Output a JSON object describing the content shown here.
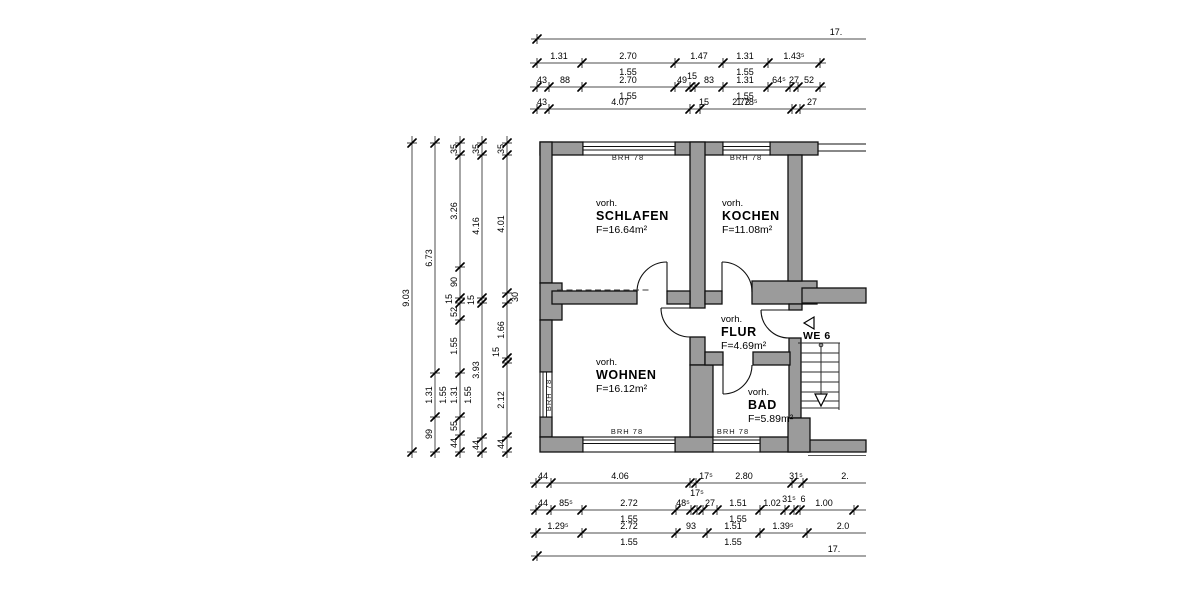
{
  "plan": {
    "rooms": [
      {
        "prefix": "vorh.",
        "name": "SCHLAFEN",
        "area": "F=16.64m²",
        "x": 596,
        "y": 206
      },
      {
        "prefix": "vorh.",
        "name": "KOCHEN",
        "area": "F=11.08m²",
        "x": 722,
        "y": 206
      },
      {
        "prefix": "vorh.",
        "name": "WOHNEN",
        "area": "F=16.12m²",
        "x": 596,
        "y": 365
      },
      {
        "prefix": "vorh.",
        "name": "FLUR",
        "area": "F=4.69m²",
        "x": 721,
        "y": 322
      },
      {
        "prefix": "vorh.",
        "name": "BAD",
        "area": "F=5.89m²",
        "x": 748,
        "y": 395
      }
    ],
    "window_sill_labels": [
      {
        "text": "BRH 78",
        "x": 628,
        "y": 160,
        "rotate": 0
      },
      {
        "text": "BRH 78",
        "x": 746,
        "y": 160,
        "rotate": 0
      },
      {
        "text": "BRH 78",
        "x": 627,
        "y": 434,
        "rotate": 0
      },
      {
        "text": "BRH 78",
        "x": 733,
        "y": 434,
        "rotate": 0
      },
      {
        "text": "BRH 78",
        "x": 551,
        "y": 395,
        "rotate": -90
      }
    ],
    "apartment_label": {
      "text": "WE 6",
      "x": 803,
      "y": 339
    }
  },
  "dimensions": {
    "horizontal_chains": [
      {
        "y": 39,
        "x1": 531,
        "x2": 866,
        "ticks": [
          537
        ],
        "labels": [
          {
            "t": "17.",
            "x": 836,
            "p": "a"
          }
        ]
      },
      {
        "y": 63,
        "x1": 530,
        "x2": 826,
        "ticks": [
          537,
          582,
          675,
          723,
          768,
          820
        ],
        "labels": [
          {
            "t": "1.31",
            "x": 559,
            "p": "a"
          },
          {
            "t": "2.70",
            "x": 628,
            "p": "a"
          },
          {
            "t": "1.47",
            "x": 699,
            "p": "a"
          },
          {
            "t": "1.31",
            "x": 745,
            "p": "a"
          },
          {
            "t": "1.43⁵",
            "x": 794,
            "p": "a"
          },
          {
            "t": "1.55",
            "x": 628,
            "p": "b"
          },
          {
            "t": "1.55",
            "x": 745,
            "p": "b"
          }
        ]
      },
      {
        "y": 87,
        "x1": 530,
        "x2": 826,
        "ticks": [
          537,
          549,
          582,
          675,
          690,
          695,
          723,
          768,
          790,
          798,
          820
        ],
        "labels": [
          {
            "t": "43",
            "x": 542,
            "p": "a"
          },
          {
            "t": "88",
            "x": 565,
            "p": "a"
          },
          {
            "t": "2.70",
            "x": 628,
            "p": "a"
          },
          {
            "t": "49",
            "x": 682,
            "p": "a"
          },
          {
            "t": "15",
            "x": 692,
            "p": "a",
            "dy": -4
          },
          {
            "t": "83",
            "x": 709,
            "p": "a"
          },
          {
            "t": "1.31",
            "x": 745,
            "p": "a"
          },
          {
            "t": "64⁵",
            "x": 779,
            "p": "a"
          },
          {
            "t": "27",
            "x": 794,
            "p": "a"
          },
          {
            "t": "52",
            "x": 809,
            "p": "a"
          },
          {
            "t": "1.55",
            "x": 628,
            "p": "b"
          },
          {
            "t": "1.55",
            "x": 745,
            "p": "b"
          }
        ]
      },
      {
        "y": 109,
        "x1": 530,
        "x2": 866,
        "ticks": [
          537,
          549,
          690,
          700,
          792,
          800
        ],
        "labels": [
          {
            "t": "43",
            "x": 542,
            "p": "a"
          },
          {
            "t": "4.07",
            "x": 620,
            "p": "a"
          },
          {
            "t": "15",
            "x": 704,
            "p": "a"
          },
          {
            "t": "2.72",
            "x": 741,
            "p": "a"
          },
          {
            "t": "1.78⁵",
            "x": 747,
            "p": "a"
          },
          {
            "t": "27",
            "x": 812,
            "p": "a"
          }
        ]
      },
      {
        "y": 483,
        "x1": 530,
        "x2": 866,
        "ticks": [
          536,
          551,
          690,
          696,
          792,
          803
        ],
        "labels": [
          {
            "t": "44",
            "x": 543,
            "p": "a"
          },
          {
            "t": "4.06",
            "x": 620,
            "p": "a"
          },
          {
            "t": "17⁵",
            "x": 706,
            "p": "a"
          },
          {
            "t": "2.80",
            "x": 744,
            "p": "a"
          },
          {
            "t": "31⁵",
            "x": 796,
            "p": "a"
          },
          {
            "t": "2.",
            "x": 845,
            "p": "a"
          }
        ]
      },
      {
        "y": 510,
        "x1": 530,
        "x2": 866,
        "ticks": [
          536,
          551,
          582,
          676,
          691,
          697,
          703,
          717,
          760,
          785,
          794,
          800,
          854
        ],
        "labels": [
          {
            "t": "44",
            "x": 543,
            "p": "a"
          },
          {
            "t": "85⁵",
            "x": 566,
            "p": "a"
          },
          {
            "t": "2.72",
            "x": 629,
            "p": "a"
          },
          {
            "t": "48⁵",
            "x": 683,
            "p": "a"
          },
          {
            "t": "17⁵",
            "x": 697,
            "p": "a",
            "dy": -10
          },
          {
            "t": "27",
            "x": 710,
            "p": "a"
          },
          {
            "t": "1.51",
            "x": 738,
            "p": "a"
          },
          {
            "t": "1.02",
            "x": 772,
            "p": "a"
          },
          {
            "t": "31⁵",
            "x": 789,
            "p": "a",
            "dy": -4
          },
          {
            "t": "6",
            "x": 803,
            "p": "a",
            "dy": -4
          },
          {
            "t": "1.00",
            "x": 824,
            "p": "a"
          },
          {
            "t": "1.55",
            "x": 629,
            "p": "b"
          },
          {
            "t": "1.55",
            "x": 738,
            "p": "b"
          }
        ]
      },
      {
        "y": 533,
        "x1": 530,
        "x2": 866,
        "ticks": [
          536,
          582,
          676,
          707,
          760,
          807
        ],
        "labels": [
          {
            "t": "1.29⁵",
            "x": 558,
            "p": "a"
          },
          {
            "t": "2.72",
            "x": 629,
            "p": "a"
          },
          {
            "t": "93",
            "x": 691,
            "p": "a"
          },
          {
            "t": "1.51",
            "x": 733,
            "p": "a"
          },
          {
            "t": "1.39⁵",
            "x": 783,
            "p": "a"
          },
          {
            "t": "2.0",
            "x": 843,
            "p": "a"
          },
          {
            "t": "1.55",
            "x": 629,
            "p": "b"
          },
          {
            "t": "1.55",
            "x": 733,
            "p": "b"
          }
        ]
      },
      {
        "y": 556,
        "x1": 531,
        "x2": 866,
        "ticks": [
          537
        ],
        "labels": [
          {
            "t": "17.",
            "x": 834,
            "p": "a"
          }
        ]
      }
    ],
    "vertical_chains": [
      {
        "x": 412,
        "y1": 136,
        "y2": 458,
        "ticks": [
          143,
          452
        ],
        "labels": [
          {
            "t": "9.03",
            "y": 298,
            "p": "l"
          }
        ]
      },
      {
        "x": 435,
        "y1": 136,
        "y2": 458,
        "ticks": [
          143,
          373,
          417,
          452
        ],
        "labels": [
          {
            "t": "6.73",
            "y": 258,
            "p": "l"
          },
          {
            "t": "1.31",
            "y": 395,
            "p": "l"
          },
          {
            "t": "1.55",
            "y": 395,
            "p": "r"
          },
          {
            "t": "99",
            "y": 434,
            "p": "l"
          }
        ]
      },
      {
        "x": 460,
        "y1": 136,
        "y2": 458,
        "ticks": [
          143,
          155,
          267,
          298,
          303,
          320,
          373,
          417,
          435,
          452
        ],
        "labels": [
          {
            "t": "35",
            "y": 149,
            "p": "l"
          },
          {
            "t": "3.26",
            "y": 211,
            "p": "l"
          },
          {
            "t": "90",
            "y": 282,
            "p": "l"
          },
          {
            "t": "15",
            "y": 299,
            "p": "l",
            "dx": -8
          },
          {
            "t": "52",
            "y": 312,
            "p": "l"
          },
          {
            "t": "1.55",
            "y": 346,
            "p": "l"
          },
          {
            "t": "1.31",
            "y": 395,
            "p": "l"
          },
          {
            "t": "1.55",
            "y": 395,
            "p": "r"
          },
          {
            "t": "55",
            "y": 426,
            "p": "l"
          },
          {
            "t": "44",
            "y": 443,
            "p": "l"
          }
        ]
      },
      {
        "x": 482,
        "y1": 136,
        "y2": 458,
        "ticks": [
          143,
          155,
          298,
          303,
          438,
          452
        ],
        "labels": [
          {
            "t": "35",
            "y": 149,
            "p": "l"
          },
          {
            "t": "4.16",
            "y": 226,
            "p": "l"
          },
          {
            "t": "15",
            "y": 300,
            "p": "l",
            "dx": -8
          },
          {
            "t": "3.93",
            "y": 370,
            "p": "l"
          },
          {
            "t": "44",
            "y": 445,
            "p": "l"
          }
        ]
      },
      {
        "x": 507,
        "y1": 136,
        "y2": 458,
        "ticks": [
          143,
          155,
          293,
          303,
          358,
          363,
          437,
          452
        ],
        "labels": [
          {
            "t": "35",
            "y": 149,
            "p": "l"
          },
          {
            "t": "4.01",
            "y": 224,
            "p": "l"
          },
          {
            "t": "30",
            "y": 297,
            "p": "r"
          },
          {
            "t": "1.66",
            "y": 330,
            "p": "l"
          },
          {
            "t": "15",
            "y": 352,
            "p": "l",
            "dx": -8
          },
          {
            "t": "2.12",
            "y": 400,
            "p": "l"
          },
          {
            "t": "44",
            "y": 444,
            "p": "l"
          }
        ]
      }
    ]
  }
}
